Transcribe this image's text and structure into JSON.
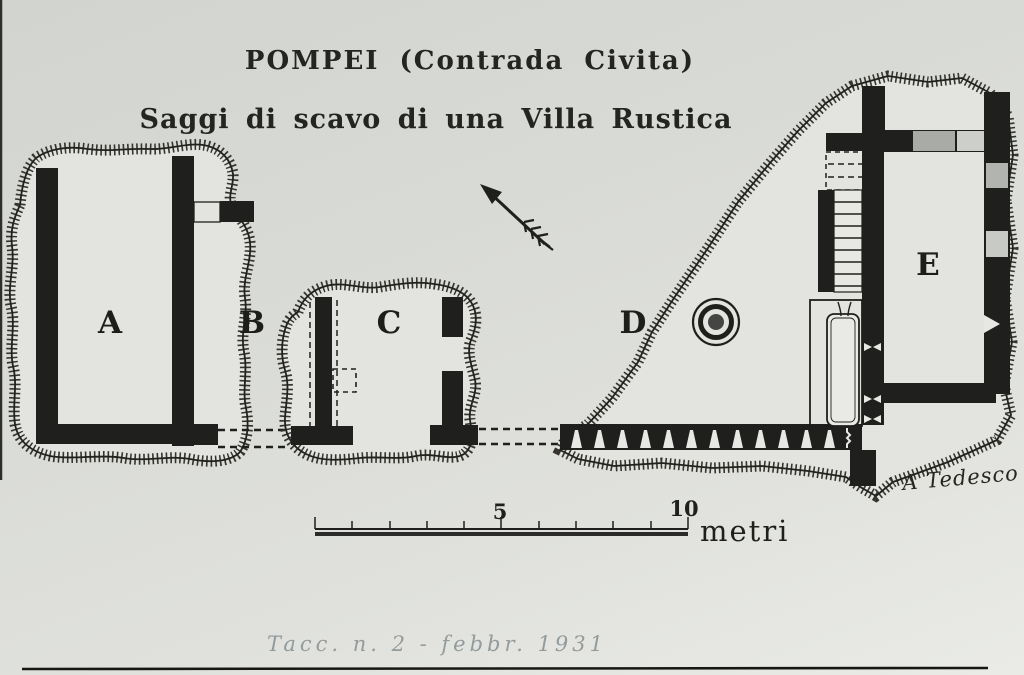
{
  "doc": {
    "title_line1": "POMPEI (Contrada Civita)",
    "title_line2": "Saggi di scavo di una Villa Rustica",
    "area_labels": [
      {
        "char": "A"
      },
      {
        "char": "B"
      },
      {
        "char": "C"
      },
      {
        "char": "D"
      },
      {
        "char": "E"
      }
    ],
    "scale_bar": {
      "label_mid": "5",
      "label_end": "10",
      "unit": "metri"
    },
    "signature": "A Tedesco",
    "handwritten_note": "Tacc. n. 2 - febbr. 1931",
    "icons": {
      "north_arrow": "north-arrow-icon",
      "well": "well-icon"
    },
    "colors": {
      "ink": "#1f1f1d",
      "paper": "#d8dad6",
      "trench_fill": "#e3e4e0",
      "opening_gray": "#a9aba6",
      "opening_light": "#cdcfca",
      "pencil_gray": "#939b9d"
    }
  }
}
